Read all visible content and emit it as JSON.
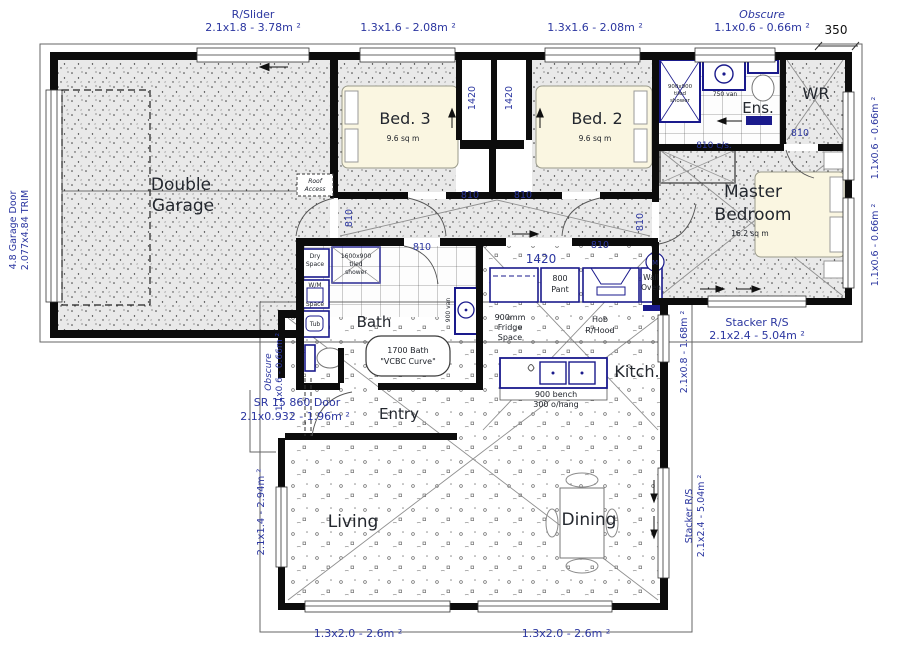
{
  "labels": {
    "rslider": "R/Slider",
    "rslider_dim": "2.1x1.8 - 3.78m ²",
    "w13x16": "1.3x1.6 - 2.08m ²",
    "obscure": "Obscure",
    "obscure_dim": "1.1x0.6 - 0.66m ²",
    "d350": "350",
    "garage_door1": "4.8 Garage Door",
    "garage_door2": "2.077x4.84 TRIM",
    "w11x06": "1.1x0.6 - 0.66m ²",
    "stacker": "Stacker R/S",
    "stacker_dim": "2.1x2.4 - 5.04m ²",
    "w21x08": "2.1x0.8 - 1.68m ²",
    "w21x14": "2.1x1.4 - 2.94m ²",
    "w13x20": "1.3x2.0 - 2.6m ²",
    "sr_door1": "SR 15 860 Door",
    "sr_door2": "2.1x0.932 - 1.96m ²",
    "d810": "810",
    "d810cs": "810 c/s.",
    "d1420": "1420"
  },
  "rooms": {
    "garage1": "Double",
    "garage2": "Garage",
    "bed3": "Bed. 3",
    "bed3_area": "9.6 sq m",
    "bed2": "Bed. 2",
    "bed2_area": "9.6 sq m",
    "master1": "Master",
    "master2": "Bedroom",
    "master_area": "16.2 sq m",
    "ens": "Ens.",
    "wr": "WR",
    "bath": "Bath",
    "entry": "Entry",
    "kitchen": "Kitch.",
    "living": "Living",
    "dining": "Dining"
  },
  "fixtures": {
    "ens_shower1": "900x900",
    "ens_shower2": "tiled",
    "ens_shower3": "shower",
    "ens_van": "750 van",
    "bath_shower1": "1600x900",
    "bath_shower2": "tiled",
    "bath_shower3": "shower",
    "bath_van": "900 van",
    "tub_line1": "1700 Bath",
    "tub_line2": "\"VCBC Curve\"",
    "dry1": "Dry",
    "dry2": "Space",
    "wm1": "W/M",
    "wm2": "Space",
    "tub": "Tub",
    "fridge1": "900mm",
    "fridge2": "Fridge",
    "fridge3": "Space",
    "pant1": "800",
    "pant2": "Pant",
    "oven1": "Wall",
    "oven2": "Oven",
    "hob1": "Hob",
    "hob2": "R/Hood",
    "bench1": "900 bench",
    "bench2": "300 o/hang",
    "roof1": "Roof",
    "roof2": "Access",
    "alarm": "M"
  },
  "colors": {
    "wall": "#0c0c0c",
    "annotation_blue": "#2b36a0",
    "fixture_navy": "#1a1a8c",
    "floor_grey": "#e9e9e9"
  }
}
